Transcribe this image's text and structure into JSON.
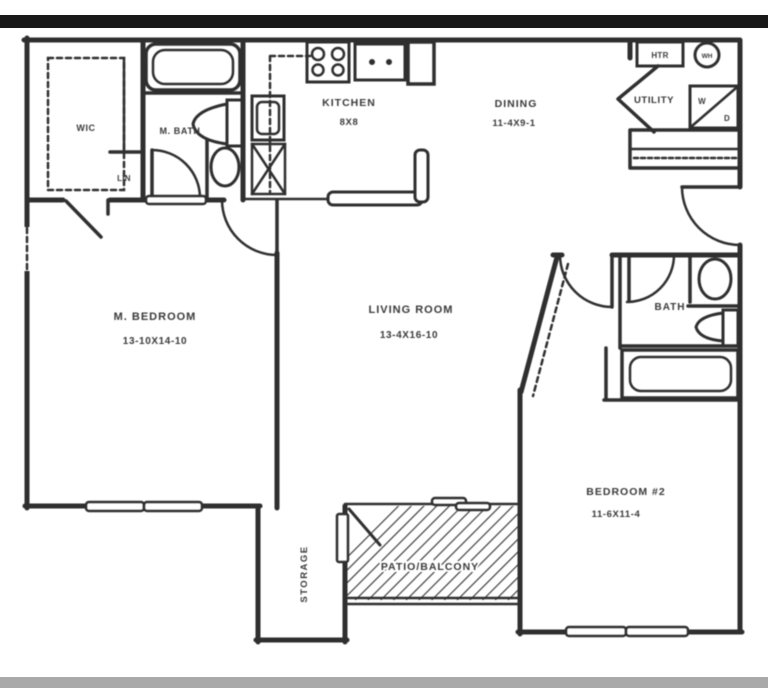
{
  "palette": {
    "paper": "#ffffff",
    "line": "#2f2f2f",
    "text": "#3a3a3a",
    "top_bar": "#191919",
    "bottom_bar": "#a9a9a9"
  },
  "floorplan": {
    "rooms": {
      "wic": {
        "label": "WIC"
      },
      "lin": {
        "label": "LIN"
      },
      "master_bath": {
        "label": "M. BATH"
      },
      "kitchen": {
        "label": "KITCHEN",
        "dimensions": "8X8"
      },
      "dining": {
        "label": "DINING",
        "dimensions": "11-4X9-1"
      },
      "utility": {
        "label": "UTILITY"
      },
      "master_bedroom": {
        "label": "M. BEDROOM",
        "dimensions": "13-10X14-10"
      },
      "living_room": {
        "label": "LIVING ROOM",
        "dimensions": "13-4X16-10"
      },
      "bath": {
        "label": "BATH"
      },
      "bedroom_2": {
        "label": "BEDROOM #2",
        "dimensions": "11-6X11-4"
      },
      "storage": {
        "label": "STORAGE"
      },
      "patio": {
        "label": "PATIO/BALCONY"
      }
    },
    "fixtures": {
      "heater": "HTR",
      "water_heater": "WH",
      "washer": "W",
      "dryer": "D"
    }
  }
}
